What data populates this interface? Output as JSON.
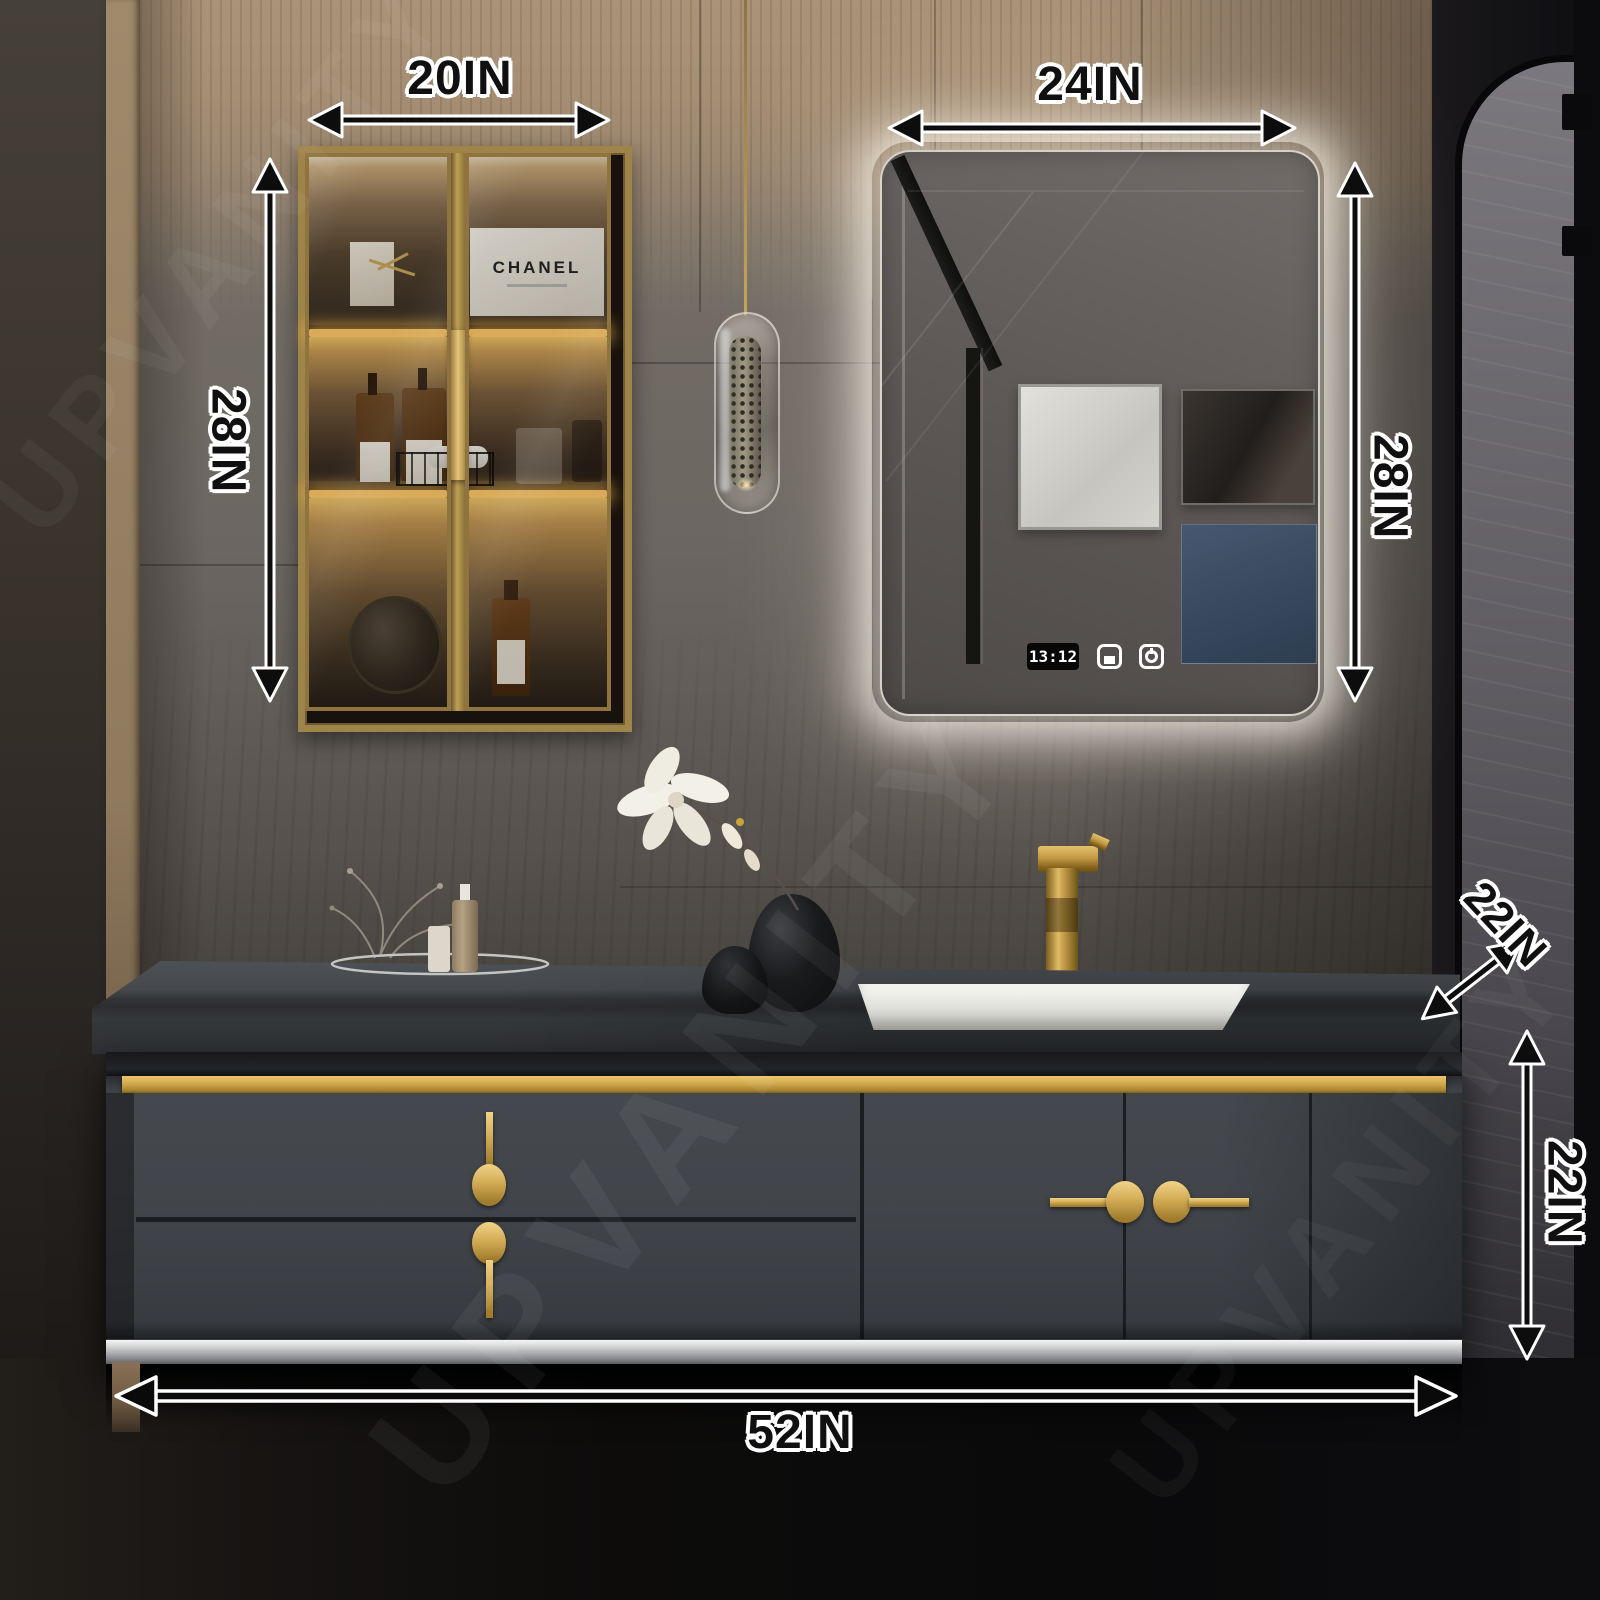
{
  "watermark": {
    "text": "UPVANITY"
  },
  "dims": {
    "cabinet_width": "20IN",
    "cabinet_height": "28IN",
    "mirror_width": "24IN",
    "mirror_height": "28IN",
    "vanity_depth": "22IN",
    "vanity_height": "22IN",
    "vanity_width": "52IN"
  },
  "mirror": {
    "clock_time": "13:12",
    "touch_controls": [
      "defog-icon",
      "power-icon"
    ]
  },
  "wall_cabinet": {
    "brand_box_text": "CHANEL"
  },
  "colors": {
    "accent_gold": "#cfa852",
    "led_warm": "#ffc967",
    "mirror_glow": "#fff8ec",
    "art_blue": "#41546c",
    "cabinet_body": "#42464b",
    "countertop": "#2a2d30",
    "sink_white": "#f2f2ee"
  }
}
